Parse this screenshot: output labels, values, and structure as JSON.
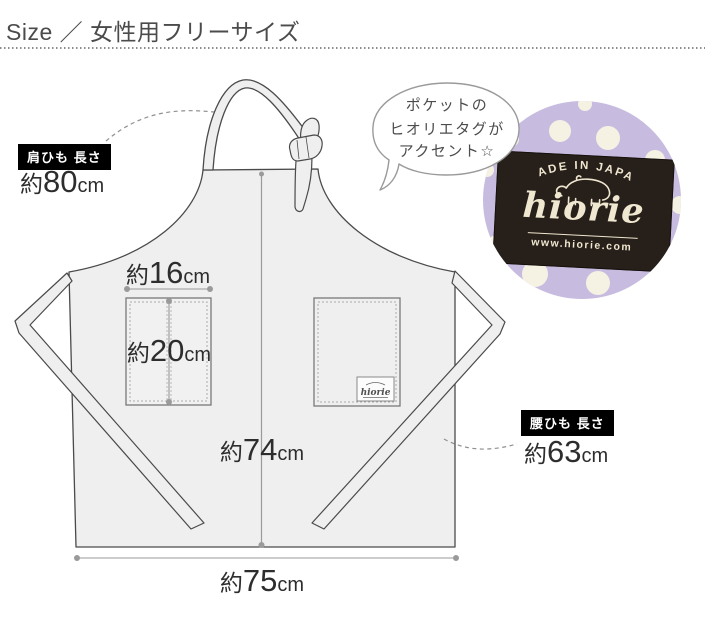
{
  "header": {
    "title": "Size ／ 女性用フリーサイズ"
  },
  "measurements": {
    "shoulder_strap": {
      "label": "肩ひも 長さ",
      "prefix": "約",
      "value": "80",
      "unit": "cm"
    },
    "waist_strap": {
      "label": "腰ひも 長さ",
      "prefix": "約",
      "value": "63",
      "unit": "cm"
    },
    "pocket_width": {
      "prefix": "約",
      "value": "16",
      "unit": "cm"
    },
    "pocket_depth": {
      "prefix": "約",
      "value": "20",
      "unit": "cm"
    },
    "body_length": {
      "prefix": "約",
      "value": "74",
      "unit": "cm"
    },
    "body_width": {
      "prefix": "約",
      "value": "75",
      "unit": "cm"
    }
  },
  "speech_bubble": {
    "lines": [
      "ポケットの",
      "ヒオリエタグが",
      "アクセント☆"
    ]
  },
  "brand_tag": {
    "arc_text": "MADE IN JAPAN",
    "brand": "hiorie",
    "url": "www.hiorie.com"
  },
  "pocket_tag": {
    "brand": "hiorie"
  },
  "colors": {
    "apron_fill": "#efefef",
    "outline_dark": "#4a4a4a",
    "measure_gray": "#9a9a9a",
    "label_bg": "#000000",
    "label_text": "#ffffff",
    "fabric_lavender": "#c7bce0",
    "dot_cream": "#f6f2e3",
    "tag_bg": "#271f1a",
    "tag_text": "#efe7cf"
  }
}
